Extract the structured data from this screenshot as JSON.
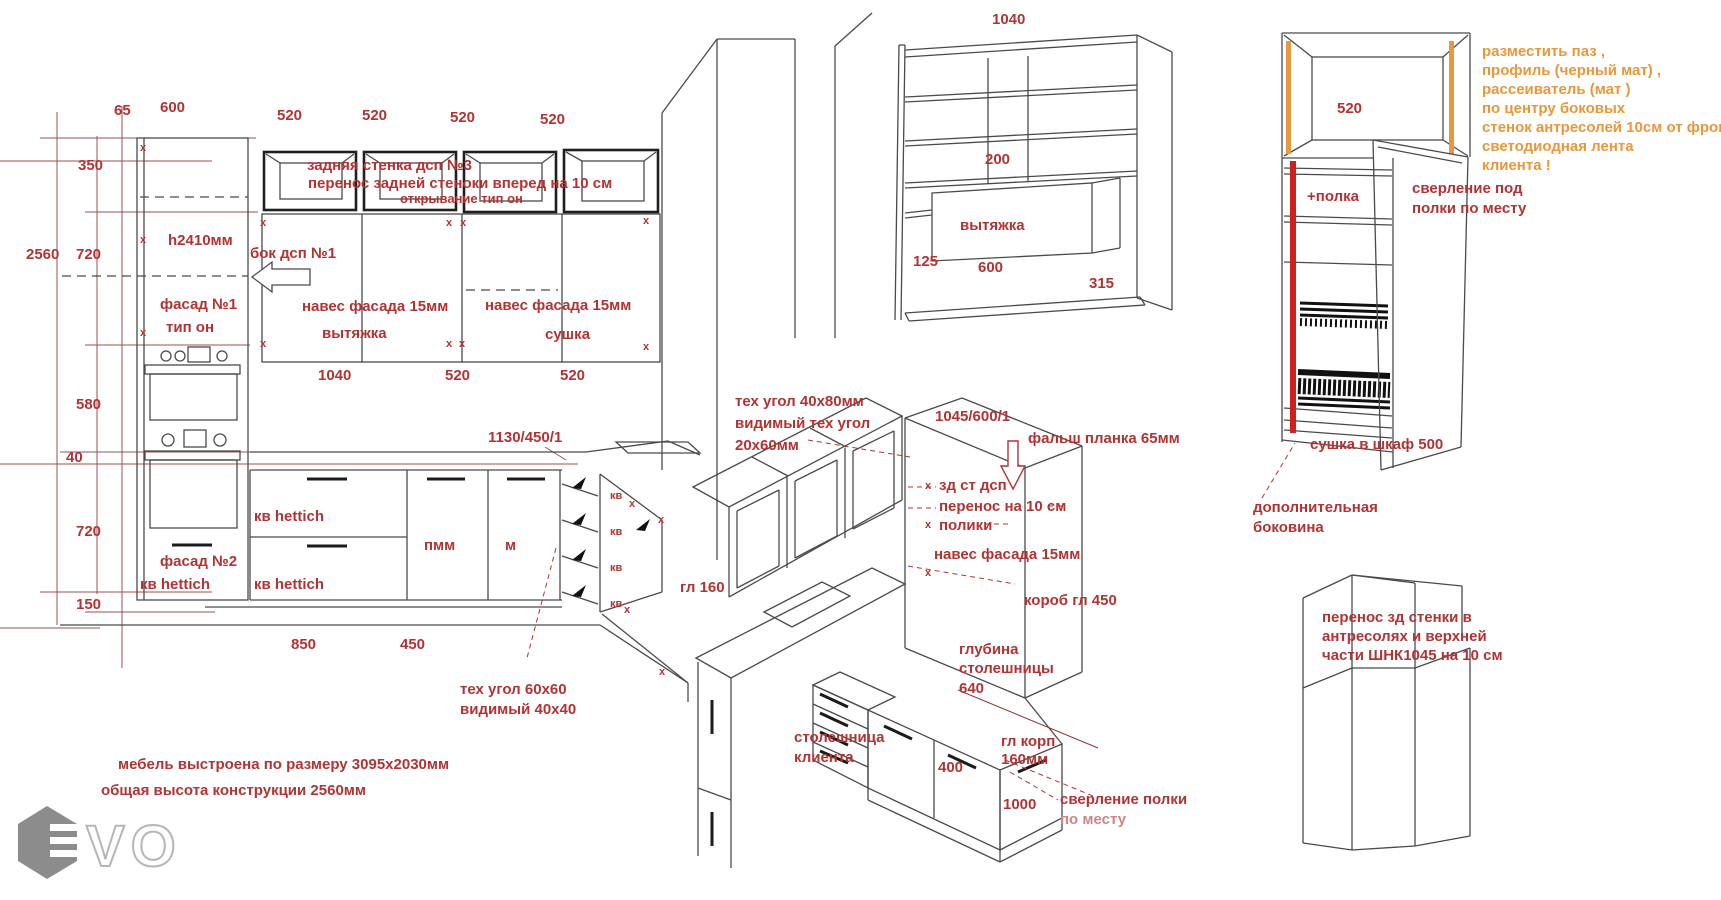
{
  "colors": {
    "red": "#b23333",
    "pink": "#cf8585",
    "orange": "#e8973b",
    "dimline": "#9b5252",
    "line": "#4a4a4a",
    "red_strip": "#cf2020",
    "orange_strip": "#e59a40",
    "logo_gray": "#8c8c8c"
  },
  "logo": {
    "vo": "VO"
  },
  "views": {
    "elevation": {
      "labels": [
        {
          "n": "dim-65",
          "t": "65",
          "x": 114,
          "y": 103
        },
        {
          "n": "dim-600",
          "t": "600",
          "x": 160,
          "y": 100
        },
        {
          "n": "dim-520-top-1",
          "t": "520",
          "x": 277,
          "y": 108
        },
        {
          "n": "dim-520-top-2",
          "t": "520",
          "x": 362,
          "y": 108
        },
        {
          "n": "dim-520-top-3",
          "t": "520",
          "x": 450,
          "y": 110
        },
        {
          "n": "dim-520-top-4",
          "t": "520",
          "x": 540,
          "y": 112
        },
        {
          "n": "dim-350",
          "t": "350",
          "x": 78,
          "y": 158
        },
        {
          "n": "dim-2560",
          "t": "2560",
          "x": 26,
          "y": 247
        },
        {
          "n": "dim-720-upper",
          "t": "720",
          "x": 76,
          "y": 247
        },
        {
          "n": "dim-580",
          "t": "580",
          "x": 76,
          "y": 397
        },
        {
          "n": "dim-40",
          "t": "40",
          "x": 66,
          "y": 450
        },
        {
          "n": "dim-720-lower",
          "t": "720",
          "x": 76,
          "y": 524
        },
        {
          "n": "dim-150",
          "t": "150",
          "x": 76,
          "y": 597
        },
        {
          "n": "note-back-wall",
          "t": "задняя стенка дсп №3",
          "x": 307,
          "y": 158
        },
        {
          "n": "note-back-wall-2",
          "t": "перенос задней стеноки вперед  на 10 см",
          "x": 308,
          "y": 176
        },
        {
          "n": "note-opening-type",
          "t": "открывание тип он",
          "x": 400,
          "y": 192,
          "s": 13
        },
        {
          "n": "note-h2410",
          "t": "h2410мм",
          "x": 168,
          "y": 233
        },
        {
          "n": "note-bok-dsp",
          "t": "бок дсп №1",
          "x": 250,
          "y": 246
        },
        {
          "n": "note-fasad-1",
          "t": "фасад №1",
          "x": 160,
          "y": 297
        },
        {
          "n": "note-tip-on",
          "t": "тип он",
          "x": 166,
          "y": 320
        },
        {
          "n": "note-naves-1",
          "t": "навес фасада 15мм",
          "x": 302,
          "y": 299
        },
        {
          "n": "note-naves-2",
          "t": "навес фасада 15мм",
          "x": 485,
          "y": 298
        },
        {
          "n": "note-vytyazhka",
          "t": "вытяжка",
          "x": 322,
          "y": 326
        },
        {
          "n": "note-sushka",
          "t": "сушка",
          "x": 545,
          "y": 327
        },
        {
          "n": "dim-1040",
          "t": "1040",
          "x": 318,
          "y": 368
        },
        {
          "n": "dim-520-bot-1",
          "t": "520",
          "x": 445,
          "y": 368
        },
        {
          "n": "dim-520-bot-2",
          "t": "520",
          "x": 560,
          "y": 368
        },
        {
          "n": "note-1130-450-1",
          "t": "1130/450/1",
          "x": 488,
          "y": 430
        },
        {
          "n": "note-kv-hettich-1",
          "t": "кв hettich",
          "x": 254,
          "y": 509
        },
        {
          "n": "note-pmm",
          "t": "пмм",
          "x": 424,
          "y": 538
        },
        {
          "n": "note-m",
          "t": "м",
          "x": 505,
          "y": 538
        },
        {
          "n": "note-fasad-2",
          "t": "фасад №2",
          "x": 160,
          "y": 554
        },
        {
          "n": "note-kv-hettich-2",
          "t": "кв hettich",
          "x": 140,
          "y": 577
        },
        {
          "n": "note-kv-hettich-3",
          "t": "кв hettich",
          "x": 254,
          "y": 577
        },
        {
          "n": "dim-850",
          "t": "850",
          "x": 291,
          "y": 637
        },
        {
          "n": "dim-450",
          "t": "450",
          "x": 400,
          "y": 637
        },
        {
          "n": "note-gl-160",
          "t": "гл 160",
          "x": 680,
          "y": 580
        },
        {
          "n": "note-teh-ugol-60",
          "t": "тех угол 60х60",
          "x": 460,
          "y": 682
        },
        {
          "n": "note-vidimyi-40",
          "t": "видимый 40х40",
          "x": 460,
          "y": 702
        },
        {
          "n": "kv-label",
          "t": "кв",
          "x": 610,
          "y": 490,
          "s": 11
        },
        {
          "n": "kv-label",
          "t": "кв",
          "x": 610,
          "y": 526,
          "s": 11
        },
        {
          "n": "kv-label",
          "t": "кв",
          "x": 610,
          "y": 562,
          "s": 11
        },
        {
          "n": "kv-label",
          "t": "кв",
          "x": 610,
          "y": 598,
          "s": 11
        },
        {
          "n": "x-mark",
          "t": "х",
          "x": 140,
          "y": 142,
          "s": 11
        },
        {
          "n": "x-mark",
          "t": "х",
          "x": 140,
          "y": 234,
          "s": 11
        },
        {
          "n": "x-mark",
          "t": "х",
          "x": 140,
          "y": 327,
          "s": 11
        },
        {
          "n": "x-mark",
          "t": "х",
          "x": 260,
          "y": 217,
          "s": 11
        },
        {
          "n": "x-mark",
          "t": "х",
          "x": 446,
          "y": 217,
          "s": 11
        },
        {
          "n": "x-mark",
          "t": "х",
          "x": 460,
          "y": 217,
          "s": 11
        },
        {
          "n": "x-mark",
          "t": "х",
          "x": 643,
          "y": 215,
          "s": 11
        },
        {
          "n": "x-mark",
          "t": "х",
          "x": 260,
          "y": 338,
          "s": 11
        },
        {
          "n": "x-mark",
          "t": "х",
          "x": 446,
          "y": 338,
          "s": 11
        },
        {
          "n": "x-mark",
          "t": "х",
          "x": 459,
          "y": 338,
          "s": 11
        },
        {
          "n": "x-mark",
          "t": "х",
          "x": 643,
          "y": 341,
          "s": 11
        },
        {
          "n": "x-mark",
          "t": "х",
          "x": 629,
          "y": 498,
          "s": 11
        },
        {
          "n": "x-mark",
          "t": "х",
          "x": 658,
          "y": 514,
          "s": 11
        },
        {
          "n": "x-mark",
          "t": "х",
          "x": 624,
          "y": 604,
          "s": 11
        },
        {
          "n": "x-mark",
          "t": "х",
          "x": 659,
          "y": 666,
          "s": 11
        }
      ]
    },
    "hood_unit": {
      "labels": [
        {
          "n": "dim-1040-hood",
          "t": "1040",
          "x": 992,
          "y": 12
        },
        {
          "n": "dim-200",
          "t": "200",
          "x": 985,
          "y": 152
        },
        {
          "n": "note-vytyazhka-3d",
          "t": "вытяжка",
          "x": 960,
          "y": 218
        },
        {
          "n": "dim-125",
          "t": "125",
          "x": 913,
          "y": 254
        },
        {
          "n": "dim-600-hood",
          "t": "600",
          "x": 978,
          "y": 260
        },
        {
          "n": "dim-315",
          "t": "315",
          "x": 1089,
          "y": 276
        }
      ]
    },
    "corner_3d": {
      "labels": [
        {
          "n": "note-teh-ugol-40x80",
          "t": "тех угол 40х80мм",
          "x": 735,
          "y": 394
        },
        {
          "n": "note-vidimyi-teh-ugol",
          "t": "видимый тех угол",
          "x": 735,
          "y": 416
        },
        {
          "n": "note-20x60",
          "t": "20х60мм",
          "x": 735,
          "y": 438
        },
        {
          "n": "note-1045-600-1",
          "t": "1045/600/1",
          "x": 935,
          "y": 409
        },
        {
          "n": "note-falsh-planka",
          "t": "фальш планка 65мм",
          "x": 1028,
          "y": 431
        },
        {
          "n": "note-zd-st-dsp",
          "t": "зд ст дсп",
          "x": 939,
          "y": 478
        },
        {
          "n": "note-perenos-10",
          "t": "перенос на 10 см",
          "x": 939,
          "y": 499
        },
        {
          "n": "note-poliki",
          "t": "полики",
          "x": 939,
          "y": 518
        },
        {
          "n": "note-naves-3d",
          "t": "навес фасада 15мм",
          "x": 934,
          "y": 547
        },
        {
          "n": "note-korob-gl-450",
          "t": "короб гл 450",
          "x": 1024,
          "y": 593
        },
        {
          "n": "note-glubina",
          "t": "глубина",
          "x": 959,
          "y": 642
        },
        {
          "n": "note-stoleshnitsy",
          "t": "столешницы",
          "x": 959,
          "y": 661
        },
        {
          "n": "dim-640",
          "t": "640",
          "x": 959,
          "y": 681
        },
        {
          "n": "note-stoleshnitsa",
          "t": "столешница",
          "x": 794,
          "y": 730
        },
        {
          "n": "note-klienta",
          "t": "клиента",
          "x": 794,
          "y": 750
        },
        {
          "n": "dim-400",
          "t": "400",
          "x": 938,
          "y": 760
        },
        {
          "n": "note-gl-korp",
          "t": "гл корп",
          "x": 1001,
          "y": 734
        },
        {
          "n": "note-160mm",
          "t": "160мм",
          "x": 1001,
          "y": 752
        },
        {
          "n": "dim-1000",
          "t": "1000",
          "x": 1003,
          "y": 797
        },
        {
          "n": "note-sverlenie-polki",
          "t": "сверление полки",
          "x": 1060,
          "y": 792
        },
        {
          "n": "note-po-mestu",
          "t": "по месту",
          "x": 1060,
          "y": 812,
          "c": "pink"
        },
        {
          "n": "x-mark",
          "t": "х",
          "x": 925,
          "y": 480,
          "s": 11
        },
        {
          "n": "x-mark",
          "t": "х",
          "x": 925,
          "y": 519,
          "s": 11
        },
        {
          "n": "x-mark",
          "t": "х",
          "x": 925,
          "y": 567,
          "s": 11
        }
      ]
    },
    "led_cabinet": {
      "labels": [
        {
          "n": "dim-520-led",
          "t": "520",
          "x": 1337,
          "y": 101
        },
        {
          "n": "note-polka",
          "t": "+полка",
          "x": 1307,
          "y": 189
        },
        {
          "n": "note-sverlenie-pod",
          "t": "сверление под",
          "x": 1412,
          "y": 181
        },
        {
          "n": "note-polki-po-mestu",
          "t": "полки по месту",
          "x": 1412,
          "y": 201
        },
        {
          "n": "note-led-1",
          "t": "разместить паз ,",
          "x": 1482,
          "y": 44,
          "c": "orange"
        },
        {
          "n": "note-led-2",
          "t": "профиль (черный мат)  ,",
          "x": 1482,
          "y": 63,
          "c": "orange"
        },
        {
          "n": "note-led-3",
          "t": "рассеиватель (мат )",
          "x": 1482,
          "y": 82,
          "c": "orange"
        },
        {
          "n": "note-led-4",
          "t": "по центру боковых",
          "x": 1482,
          "y": 101,
          "c": "orange"
        },
        {
          "n": "note-led-5",
          "t": "стенок антресолей  10см от фрона",
          "x": 1482,
          "y": 120,
          "c": "orange"
        },
        {
          "n": "note-led-6",
          "t": "светодиодная лента",
          "x": 1482,
          "y": 139,
          "c": "orange"
        },
        {
          "n": "note-led-7",
          "t": "клиента !",
          "x": 1482,
          "y": 158,
          "c": "orange"
        },
        {
          "n": "note-sushka-shkaf",
          "t": "сушка в шкаф 500",
          "x": 1310,
          "y": 437
        },
        {
          "n": "note-dopolnitelnaya",
          "t": "дополнительная",
          "x": 1253,
          "y": 500
        },
        {
          "n": "note-bokovina",
          "t": "боковина",
          "x": 1253,
          "y": 520
        }
      ]
    },
    "tower": {
      "labels": [
        {
          "n": "note-tower-1",
          "t": "перенос зд стенки в",
          "x": 1322,
          "y": 610
        },
        {
          "n": "note-tower-2",
          "t": "антресолях и верхней",
          "x": 1322,
          "y": 629
        },
        {
          "n": "note-tower-3",
          "t": "части ШНК1045 на 10 см",
          "x": 1322,
          "y": 648
        }
      ]
    },
    "footer": {
      "labels": [
        {
          "n": "note-furniture-size",
          "t": "мебель выстроена по размеру 3095х2030мм",
          "x": 118,
          "y": 757
        },
        {
          "n": "note-total-height",
          "t": "общая высота конструкции 2560мм",
          "x": 101,
          "y": 783
        }
      ]
    }
  }
}
